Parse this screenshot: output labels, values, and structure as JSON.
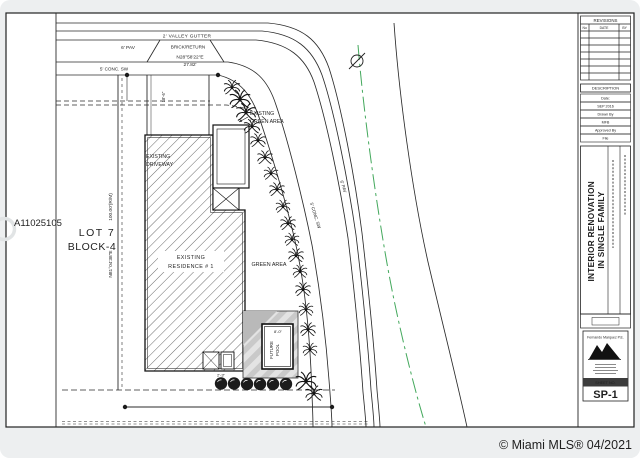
{
  "overlay": {
    "mls_id": "A11025105",
    "copyright": "© Miami MLS® 04/2021"
  },
  "plan": {
    "streets": {
      "valley_gutter": "2' VALLEY GUTTER",
      "pav_top": "6' PAV",
      "brick_return": "BRICK/RETURN",
      "bearing": "N28°58'22\"E",
      "distance": "27.82'",
      "conc_sw_top": "5' CONC. SW",
      "conc_sw_side": "5' CONC. SW",
      "pav_side": "6' PAV"
    },
    "lot": {
      "lot": "LOT 7",
      "block": "BLOCK-4",
      "side_length": "100.00'(R/M)",
      "side_bearing": "N81°04'38\"E"
    },
    "features": {
      "driveway_1": "EXISTING",
      "driveway_2": "DRIVEWAY",
      "green_top_1": "EXISTING",
      "green_top_2": "GREEN AREA",
      "residence_1": "EXISTING",
      "residence_2": "RESIDENCE # 1",
      "green_area": "GREEN AREA",
      "pool_1": "FUTURE",
      "pool_2": "POOL"
    },
    "dimensions": {
      "driveway_depth": "18'-6\"",
      "pool_width": "8'-0\"",
      "equipment": "2'-3\""
    }
  },
  "titleblock": {
    "revisions": {
      "title": "REVISIONS",
      "col_no": "No",
      "col_date": "DATE",
      "col_by": "BY"
    },
    "description": "DESCRIPTION",
    "info_rows": [
      {
        "label": "Date:"
      },
      {
        "label": "SEP 2016"
      },
      {
        "label": "Drawn By"
      },
      {
        "label": "MFB"
      },
      {
        "label": "Approved By"
      },
      {
        "label": "File"
      }
    ],
    "project_title_1": "INTERIOR RENOVATION",
    "project_title_2": "IN SINGLE FAMILY",
    "firm": "Fernando Marquez P.E.",
    "sheet_label": "SHEET NO.",
    "sheet_number": "SP-1"
  }
}
